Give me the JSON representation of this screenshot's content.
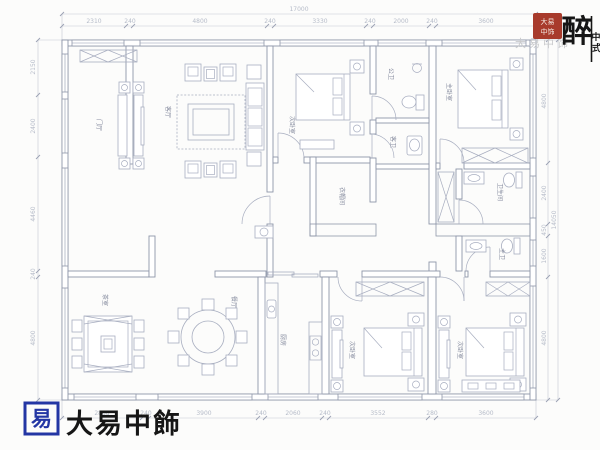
{
  "document": {
    "type": "residential floor plan"
  },
  "dims": {
    "top_overall": "17000",
    "top": [
      "2310",
      "240",
      "4800",
      "240",
      "3330",
      "240",
      "2000",
      "240",
      "3600"
    ],
    "bottom": [
      "2888",
      "240",
      "3900",
      "240",
      "2060",
      "240",
      "3552",
      "280",
      "3600"
    ],
    "left": [
      "2150",
      "2400",
      "4460",
      "240",
      "4800"
    ],
    "right": [
      "4800",
      "2400",
      "450",
      "1600",
      "4800"
    ],
    "right_overall": "14050"
  },
  "rooms": [
    {
      "label": "门厅"
    },
    {
      "label": "客厅"
    },
    {
      "label": "次卧室"
    },
    {
      "label": "公卫"
    },
    {
      "label": "客卫"
    },
    {
      "label": "主卧室"
    },
    {
      "label": "衣帽间"
    },
    {
      "label": "卫生间"
    },
    {
      "label": "主卫"
    },
    {
      "label": "茶室"
    },
    {
      "label": "餐厅"
    },
    {
      "label": "厨房"
    },
    {
      "label": "次卧室"
    },
    {
      "label": "次卧室"
    }
  ],
  "branding": {
    "seal_line1": "大易",
    "seal_line2": "中饰",
    "corner_main": "醉",
    "corner_sub_top": "中",
    "corner_sub_bottom": "式",
    "watermark": "大易中饰",
    "footer_mark": "易",
    "footer_name": "大易中飾"
  },
  "colors": {
    "wall": "#8e96a9",
    "furniture": "#a8aec0",
    "dim_text": "#b6bcc9",
    "room_label": "#878da0",
    "seal_red": "#a83b2c",
    "logo_blue": "#2336a4",
    "ink": "#161616",
    "watermark": "#c9cacc",
    "background": "#fcfcfb"
  }
}
